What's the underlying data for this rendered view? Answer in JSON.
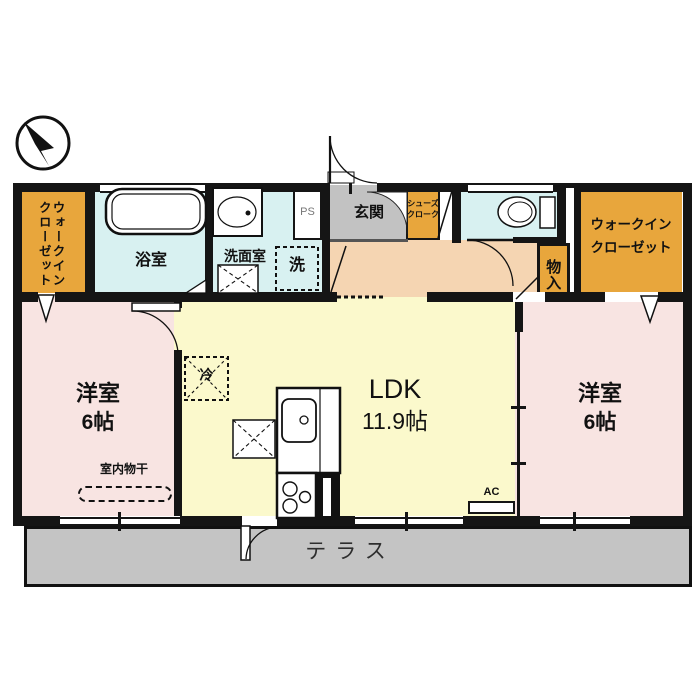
{
  "colors": {
    "wall": "#151515",
    "closet": "#E8A63C",
    "wet": "#D8F1F1",
    "pink": "#F8E4E2",
    "yellow": "#FBF9CC",
    "hall": "#F5D5B2",
    "genkan": "#C2C2C2",
    "terrace": "#C4C4C4"
  },
  "compass": {
    "icon": "north-arrow"
  },
  "rooms": {
    "wic_left": {
      "line1": "ウォークイン",
      "line2": "クローゼット"
    },
    "bath": {
      "label": "浴室"
    },
    "washroom": {
      "label": "洗面室",
      "washer": "洗",
      "ps": "PS"
    },
    "genkan": {
      "label": "玄関"
    },
    "shoes": {
      "line1": "シューズ",
      "line2": "クローク"
    },
    "toilet": {
      "fixture": "toilet"
    },
    "storage": {
      "label": "物入"
    },
    "wic_right": {
      "line1": "ウォークイン",
      "line2": "クローゼット"
    },
    "bedroom_left": {
      "line1": "洋室",
      "line2": "6帖",
      "drying": "室内物干"
    },
    "ldk": {
      "line1": "LDK",
      "line2": "11.9帖",
      "fridge": "冷",
      "ac": "AC"
    },
    "bedroom_right": {
      "line1": "洋室",
      "line2": "6帖"
    },
    "terrace": {
      "label": "テラス"
    }
  }
}
